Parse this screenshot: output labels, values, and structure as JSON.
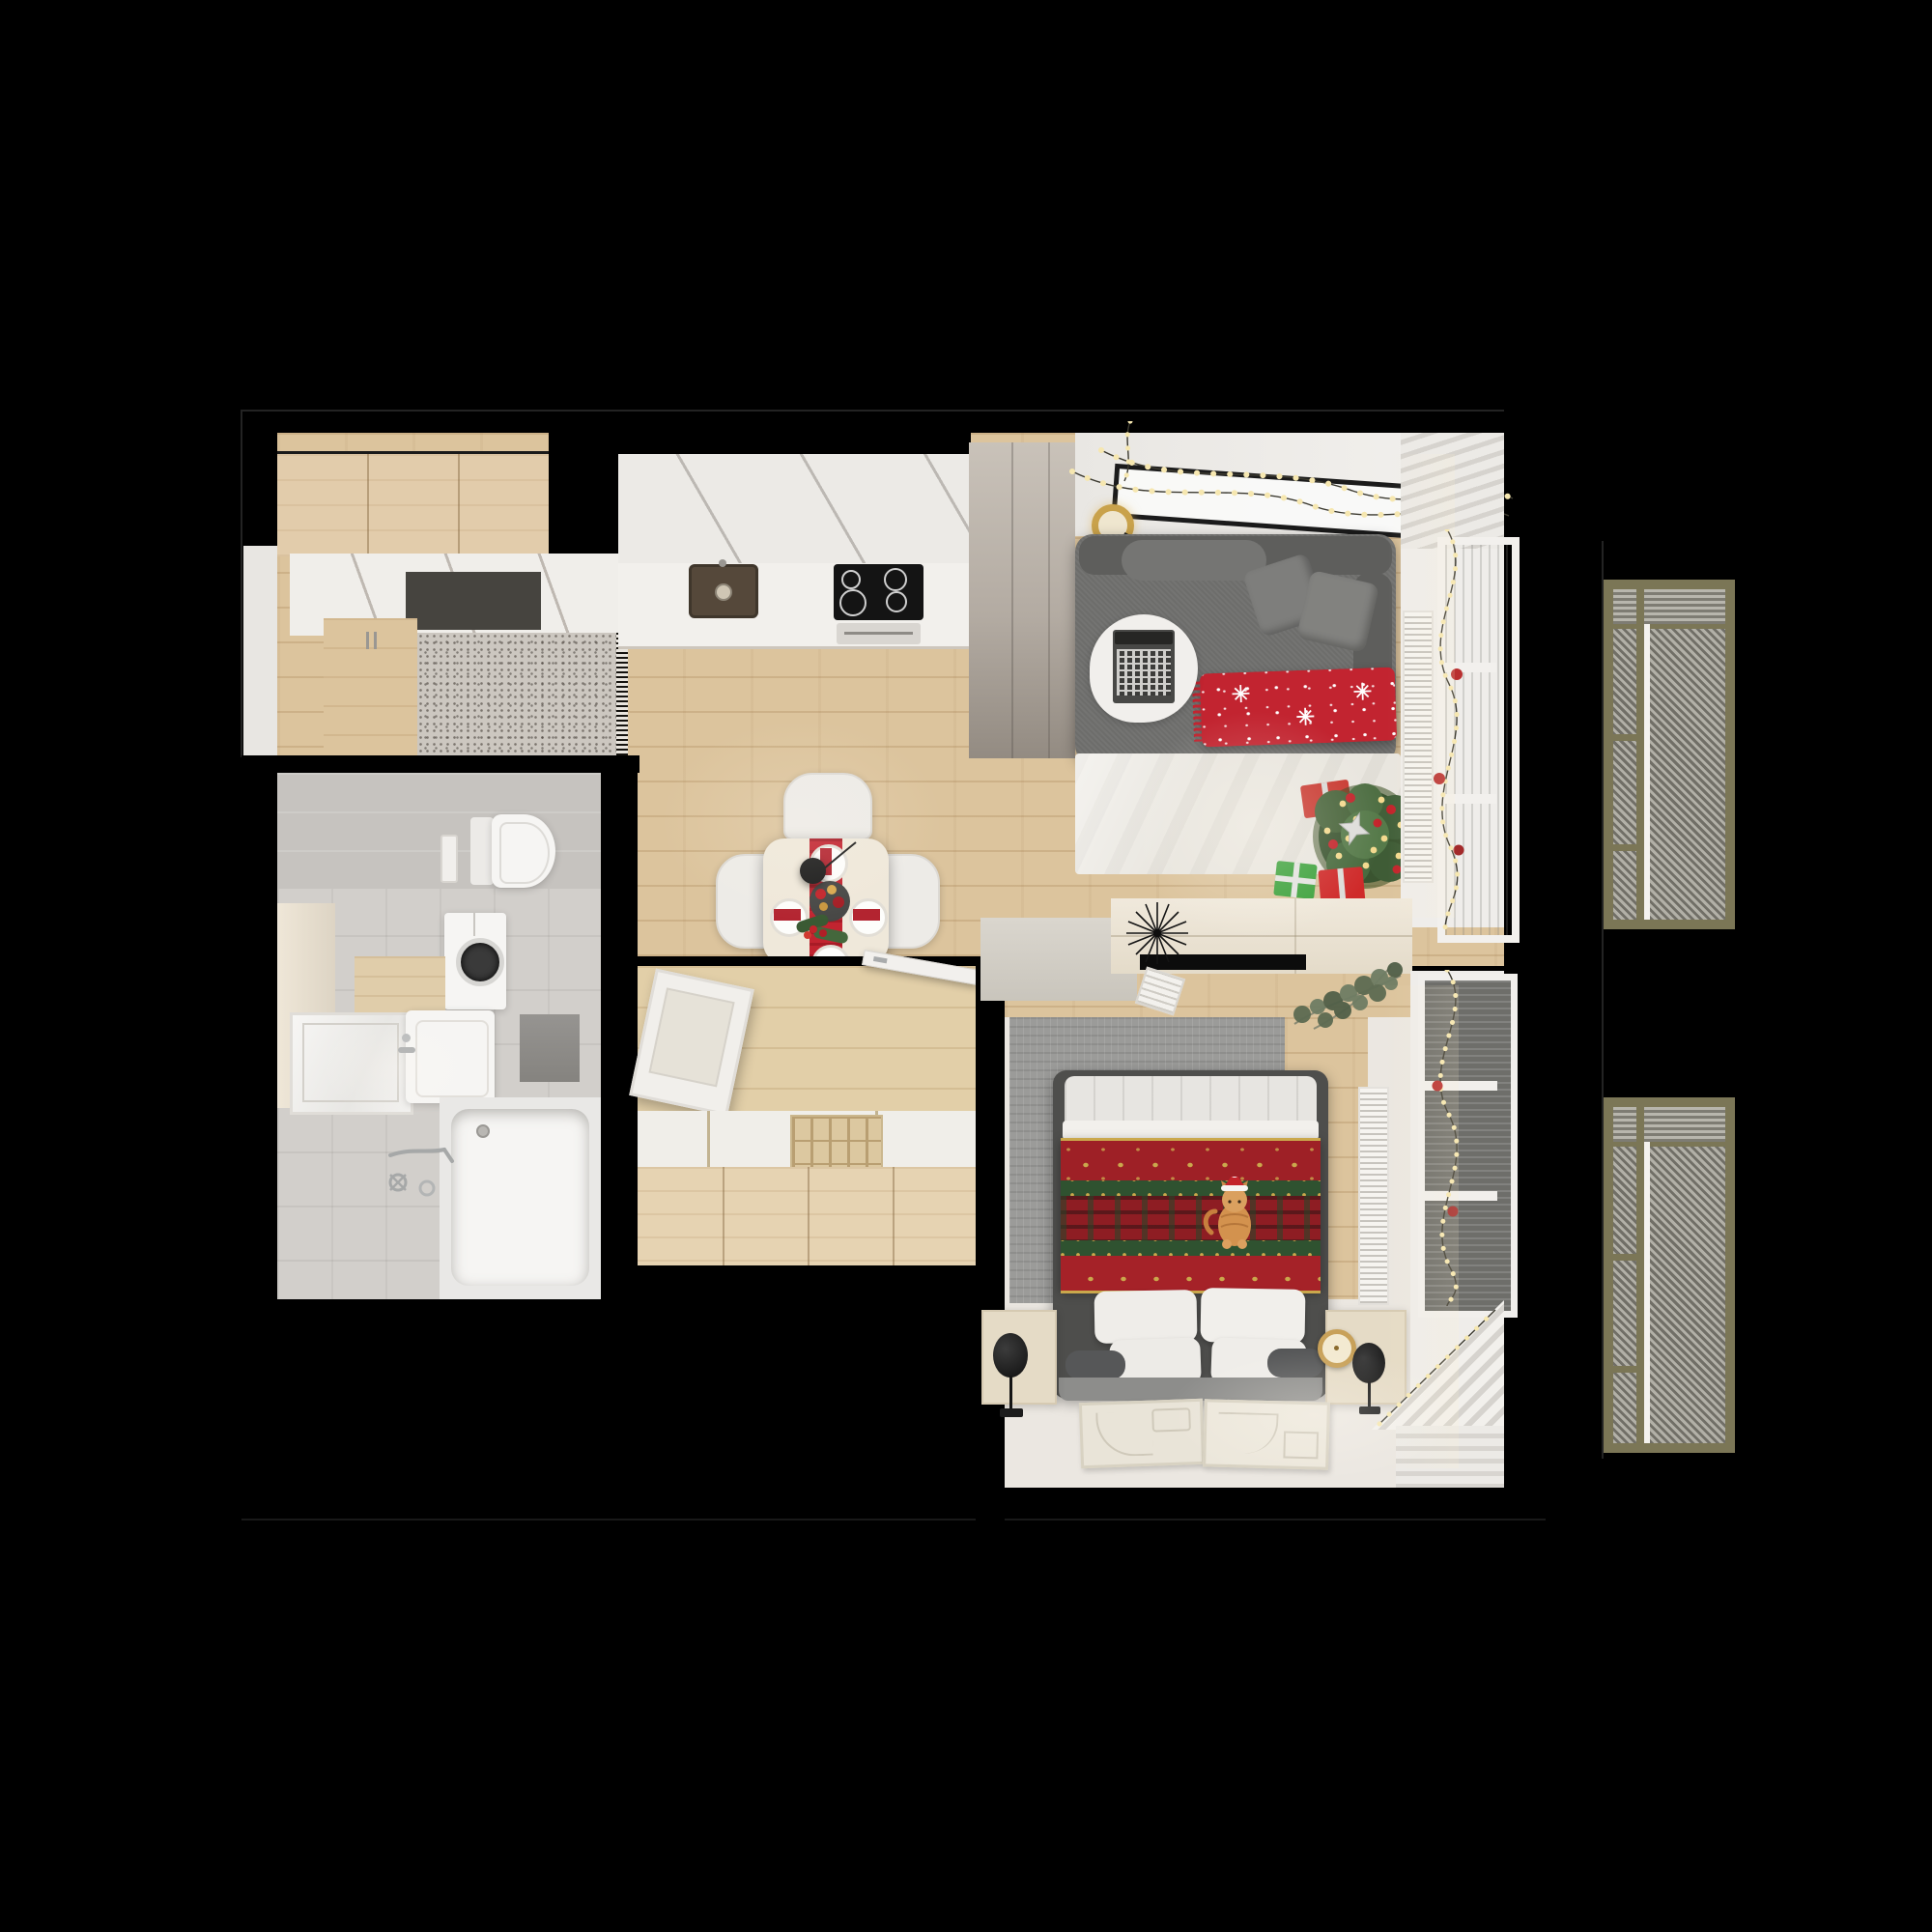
{
  "scene": {
    "type": "apartment-floor-plan-top-down-3d-render",
    "style": "photorealistic interior visualization, christmas decorated studio apartment",
    "background_color": "#000000",
    "walls_color": "#000000"
  },
  "palette": {
    "bg": "#000000",
    "wood": "#dcc49d",
    "wood_light": "#e2cfa8",
    "wall": "#efedea",
    "counter": "#f2f0ec",
    "cream": "#ece4d6",
    "sofa": "#6d6d6b",
    "sofa_dark": "#5e5e5c",
    "rug_white": "#e9e6df",
    "rug_gray": "#9b9b99",
    "red": "#c22430",
    "dark_red": "#9e2026",
    "green": "#3d5531",
    "gold": "#d9a94e",
    "tile": "#cdc9c5",
    "fixture": "#f6f5f3",
    "bed_frame": "#4e4e4c",
    "nightstand": "#e5dbc6",
    "olive": "#7b7656",
    "glass": "#dddbd7",
    "glass_dark": "#6e6e6a",
    "birch": "#e2ccab"
  },
  "decor_theme": "christmas",
  "decorations": [
    "string-lights-over-tv",
    "window-garlands-with-baubles",
    "christmas-tree",
    "gift-boxes",
    "red-reindeer-throw",
    "festive-table-setting",
    "nordic-christmas-bedspread",
    "cat-with-santa-hat"
  ],
  "rooms": {
    "entry": {
      "name": "entry hall",
      "furniture": [
        "wardrobe",
        "shoe-cabinet",
        "doormat",
        "speckled-rug"
      ]
    },
    "kitchen": {
      "name": "kitchen",
      "furniture": [
        "upper-cabinets",
        "countertop",
        "sink",
        "induction-cooktop",
        "oven",
        "tall-cabinet-column"
      ]
    },
    "living_room": {
      "name": "living room",
      "furniture": [
        "wall-tv",
        "gold-sconce",
        "corner-sofa",
        "gray-pillows",
        "red-christmas-throw",
        "round-side-table",
        "laptop",
        "white-area-rug",
        "christmas-tree",
        "gift-boxes",
        "window",
        "curtain",
        "radiator"
      ]
    },
    "dining_area": {
      "name": "dining area",
      "furniture": [
        "square-table",
        "chairs",
        "red-runner",
        "plates",
        "centerpiece-ornaments",
        "pendant-lamp"
      ]
    },
    "bathroom": {
      "name": "bathroom",
      "furniture": [
        "wall-hung-toilet",
        "flush-plate",
        "washing-machine",
        "wood-shelf",
        "vanity-cabinet",
        "mirror",
        "bathtub",
        "wall-faucet",
        "towel-panel"
      ]
    },
    "dressing_room": {
      "name": "dressing room",
      "furniture": [
        "open-wall-cabinet",
        "swing-door",
        "storage-bench",
        "drawer-organizer"
      ]
    },
    "bedroom": {
      "name": "bedroom",
      "furniture": [
        "double-bed",
        "christmas-bedspread",
        "pillows",
        "headboard",
        "nightstands",
        "disc-table-lamps",
        "alarm-clock",
        "gray-rug",
        "floor-art-panels",
        "console-desk",
        "spiky-decor",
        "eucalyptus-plant",
        "window",
        "radiator",
        "corner-curtain"
      ]
    },
    "balcony": {
      "name": "balcony",
      "furniture": [
        "louvered-panel-upper",
        "louvered-panel-lower"
      ]
    }
  }
}
